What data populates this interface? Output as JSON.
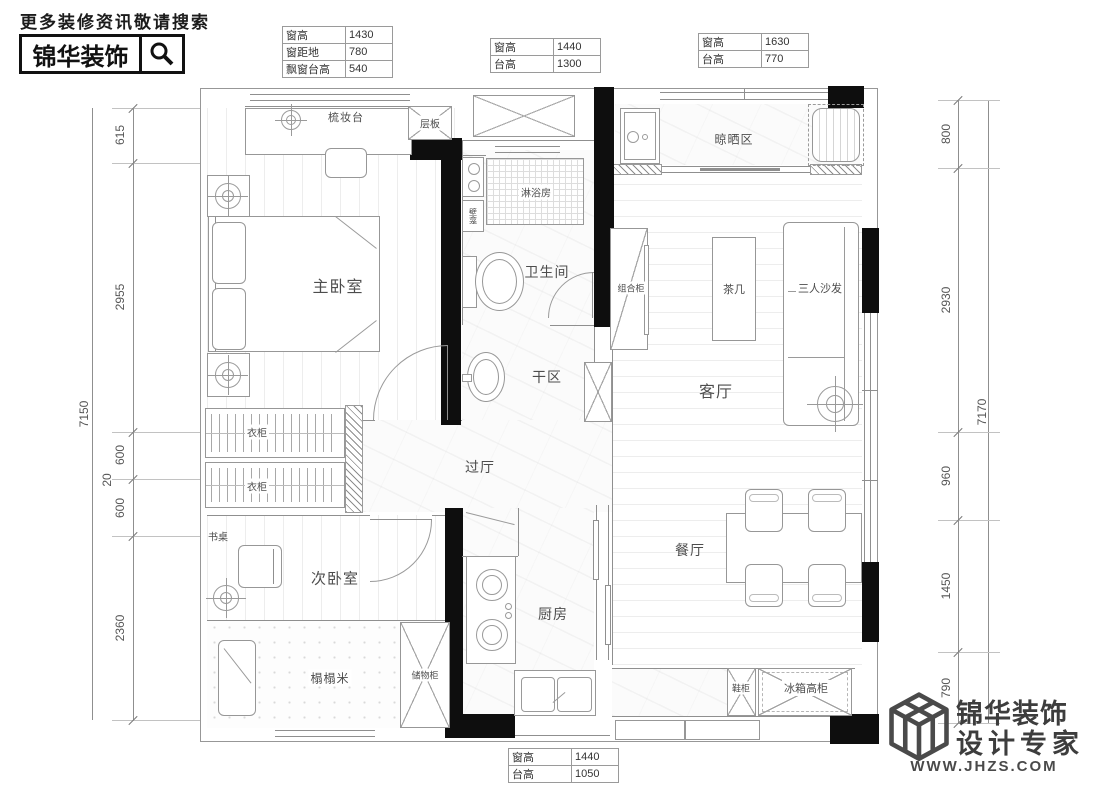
{
  "header": {
    "tagline": "更多装修资讯敬请搜索",
    "brand": "锦华装饰"
  },
  "tables": {
    "t1": {
      "rows": [
        [
          "窗高",
          "1430"
        ],
        [
          "窗距地",
          "780"
        ],
        [
          "飘窗台高",
          "540"
        ]
      ]
    },
    "t2": {
      "rows": [
        [
          "窗高",
          "1440"
        ],
        [
          "台高",
          "1300"
        ]
      ]
    },
    "t3": {
      "rows": [
        [
          "窗高",
          "1630"
        ],
        [
          "台高",
          "770"
        ]
      ]
    },
    "t4": {
      "rows": [
        [
          "窗高",
          "1440"
        ],
        [
          "台高",
          "1050"
        ]
      ]
    }
  },
  "dims": {
    "left": {
      "total": "7150",
      "segs": [
        "615",
        "2955",
        "600",
        "20",
        "600",
        "2360"
      ]
    },
    "right": {
      "total": "7170",
      "segs": [
        "800",
        "2930",
        "960",
        "1450",
        "790"
      ]
    }
  },
  "labels": {
    "dresser": "梳妆台",
    "shelf": "层板",
    "master": "主卧室",
    "shower": "淋浴房",
    "niche": "壁龛",
    "bath": "卫生间",
    "dry": "干区",
    "hall": "过厅",
    "wardrobe_a": "衣柜",
    "wardrobe_b": "衣柜",
    "desk": "书桌",
    "bedroom2": "次卧室",
    "tatami": "榻榻米",
    "storage": "储物柜",
    "kitchen": "厨房",
    "tv_cab": "组合柜",
    "tea": "茶几",
    "sofa": "三人沙发",
    "living": "客厅",
    "drying": "晾晒区",
    "dining": "餐厅",
    "shoe": "鞋柜",
    "fridge": "冰箱高柜"
  },
  "footer": {
    "brand": "锦华装饰",
    "slogan": "设计专家",
    "url": "WWW.JHZS.COM"
  }
}
